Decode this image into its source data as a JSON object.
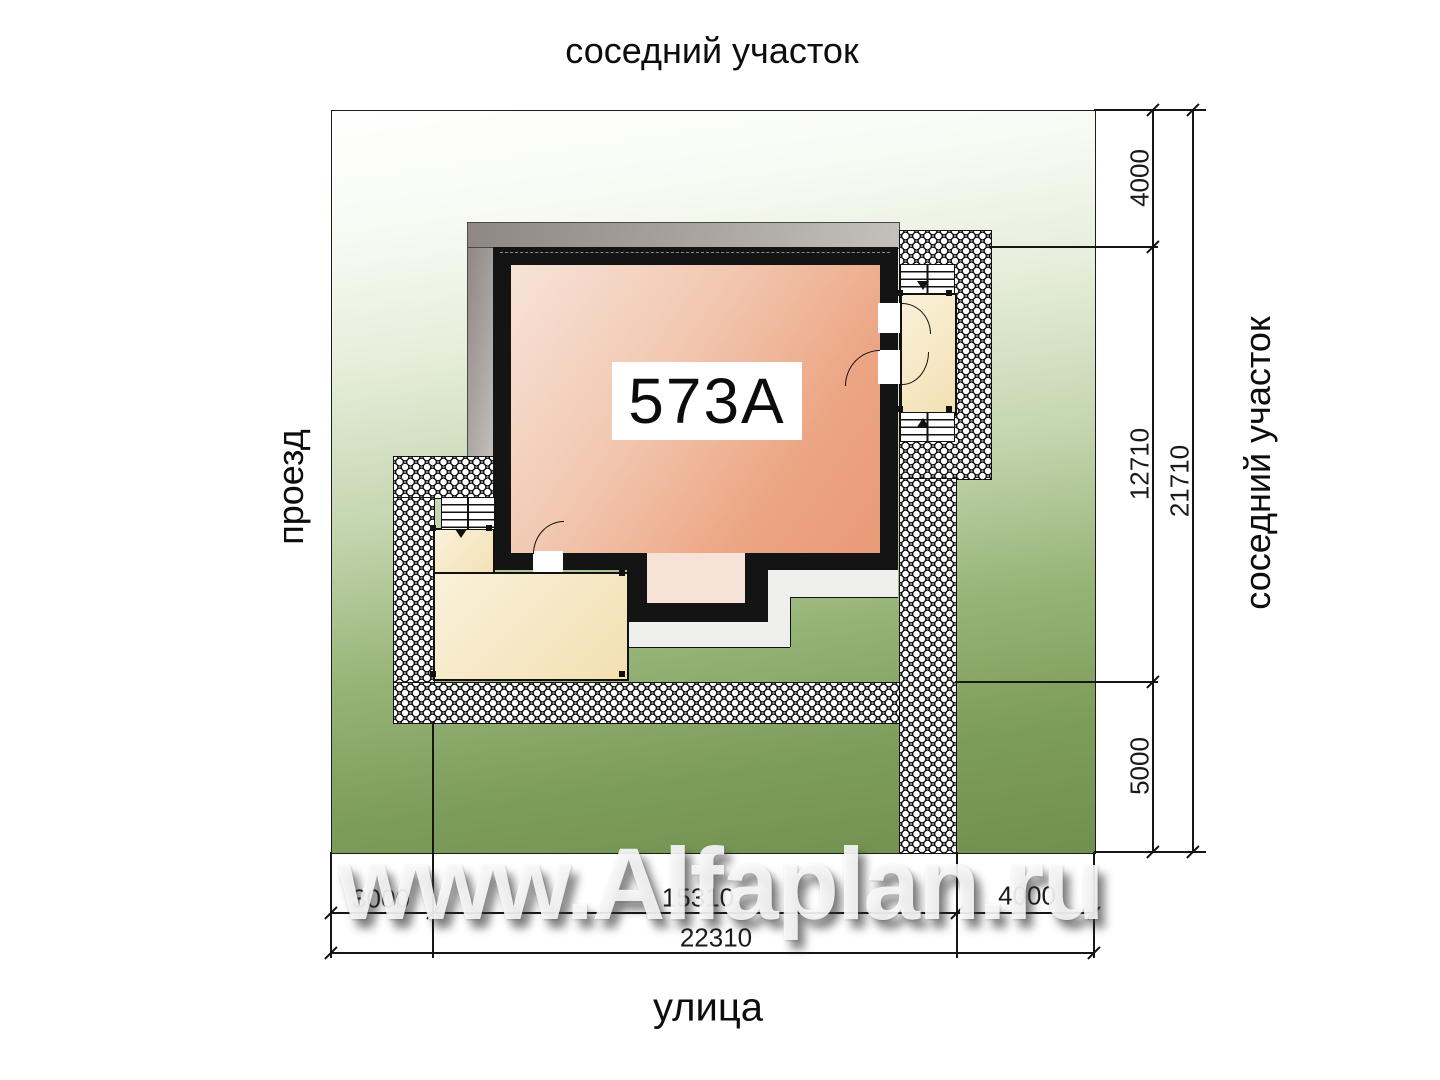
{
  "site_plan": {
    "surroundings": {
      "top": "соседний участок",
      "right": "соседний участок",
      "left": "проезд",
      "bottom": "улица"
    },
    "house": {
      "number": "573А"
    },
    "dimensions": {
      "right_segments": [
        {
          "value": "4000"
        },
        {
          "value": "12710"
        },
        {
          "value": "5000"
        }
      ],
      "right_total": {
        "value": "21710"
      },
      "bottom_segments": [
        {
          "value": "3000"
        },
        {
          "value": "15310"
        },
        {
          "value": "4000"
        }
      ],
      "bottom_total": {
        "value": "22310"
      }
    },
    "watermark": {
      "text": "www.Alfaplan.ru"
    },
    "colors": {
      "lawn_green": "#7b9c59",
      "house_fill": "#ea9f7e",
      "terrace_fill": "#f3e0b2",
      "roof_grey": "#aaa5a0",
      "wall_black": "#141414",
      "paving": "#ffffff"
    }
  }
}
